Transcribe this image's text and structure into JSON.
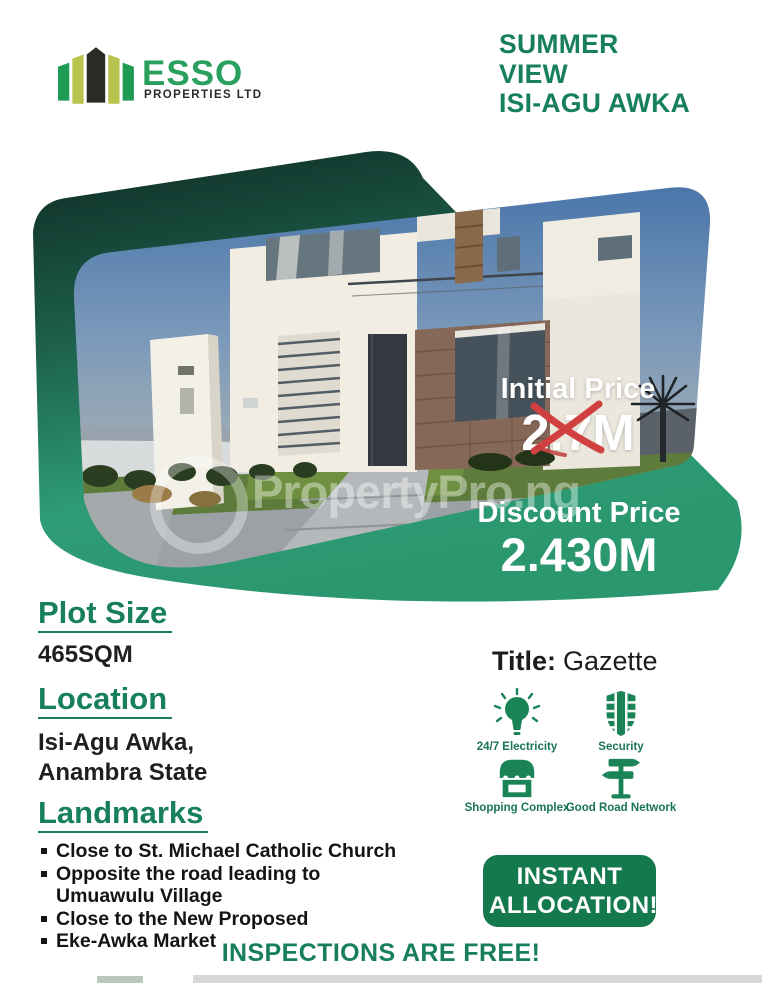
{
  "logo": {
    "name": "ESSO",
    "subtitle": "PROPERTIES LTD"
  },
  "header": {
    "line1": "SUMMER",
    "line2": "VIEW",
    "line3": "ISI-AGU AWKA"
  },
  "hero": {
    "initial_price_label": "Initial Price",
    "initial_price_value": "2.7M",
    "discount_price_label": "Discount Price",
    "discount_price_value": "2.430M",
    "watermark": "PropertyPro.ng"
  },
  "details": {
    "plot_size_label": "Plot Size",
    "plot_size_value": "465SQM",
    "location_label": "Location",
    "location_line1": "Isi-Agu Awka,",
    "location_line2": "Anambra State",
    "landmarks_label": "Landmarks",
    "landmarks": [
      {
        "text": "Close to St. Michael Catholic Church",
        "wrap": ""
      },
      {
        "text": "Opposite the road leading to",
        "wrap": "Umuawulu  Village"
      },
      {
        "text": "Close to the New Proposed",
        "wrap": ""
      },
      {
        "text": "Eke-Awka Market",
        "wrap": ""
      }
    ]
  },
  "title_info": {
    "label": "Title:",
    "value": "Gazette"
  },
  "features": [
    {
      "icon": "electricity-icon",
      "label": "24/7 Electricity"
    },
    {
      "icon": "security-icon",
      "label": "Security"
    },
    {
      "icon": "shopping-icon",
      "label": "Shopping Complex"
    },
    {
      "icon": "road-icon",
      "label": "Good Road Network"
    }
  ],
  "cta": {
    "line1": "INSTANT",
    "line2": "ALLOCATION!"
  },
  "footer": {
    "text": "INSPECTIONS ARE FREE!"
  },
  "colors": {
    "accent_green": "#17805a",
    "button_green": "#15794e",
    "logo_green": "#2aa05e",
    "logo_lime": "#b8c44d",
    "backdrop_teal": "#2f9e78",
    "strike_red": "#d04040"
  }
}
